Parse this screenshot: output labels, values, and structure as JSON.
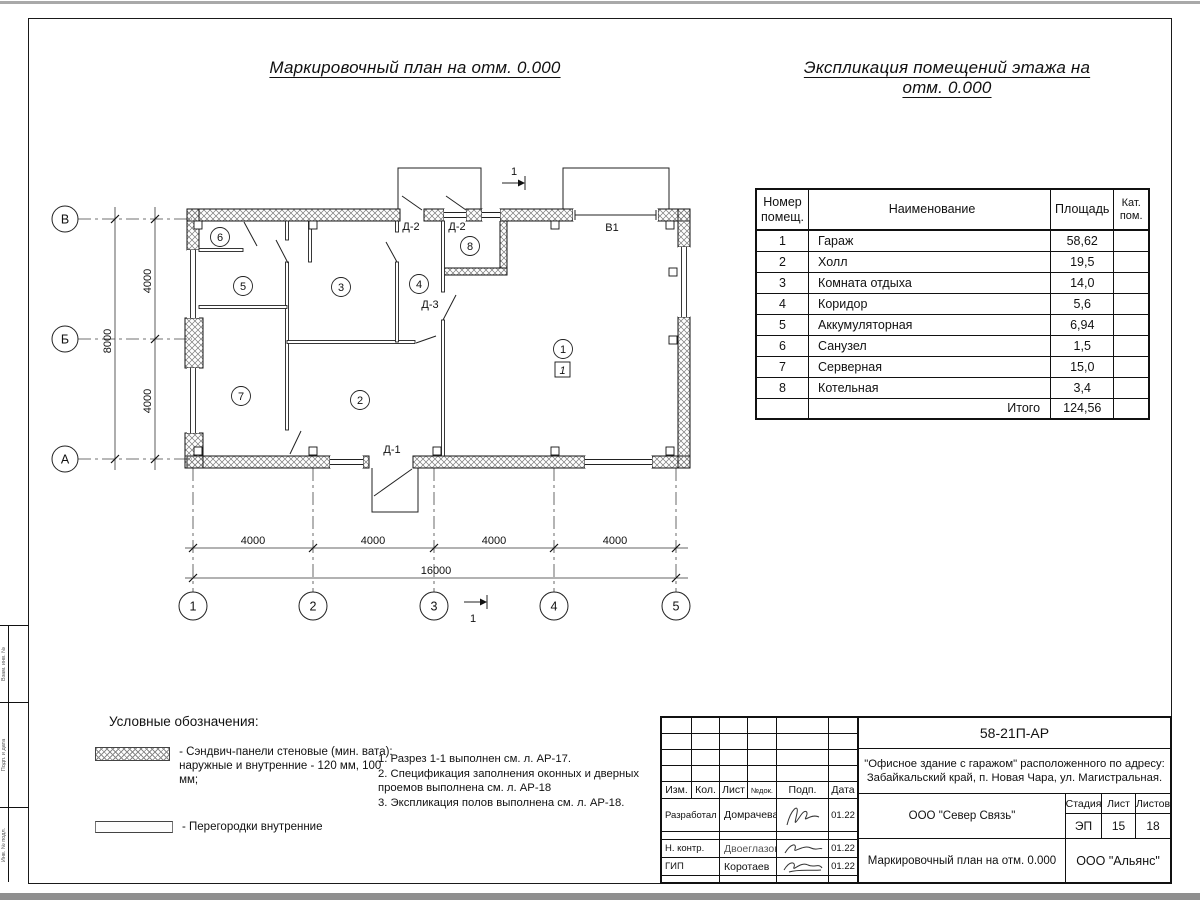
{
  "titles": {
    "plan": "Маркировочный план на отм. 0.000",
    "explication": "Экспликация помещений этажа на отм. 0.000"
  },
  "plan": {
    "axis_rows": [
      "В",
      "Б",
      "А"
    ],
    "axis_cols": [
      "1",
      "2",
      "3",
      "4",
      "5"
    ],
    "dims_v": [
      "4000",
      "4000",
      "8000"
    ],
    "dims_h": [
      "4000",
      "4000",
      "4000",
      "4000"
    ],
    "dim_total": "16000",
    "room_marks": [
      "1",
      "2",
      "3",
      "4",
      "5",
      "6",
      "7",
      "8"
    ],
    "doors": [
      "Д-1",
      "Д-2",
      "Д-2",
      "Д-3"
    ],
    "gate": "В1",
    "section": "1",
    "floor_type": "1"
  },
  "room_table": {
    "headers": {
      "num": "Номер помещ.",
      "name": "Наименование",
      "area": "Площадь",
      "cat": "Кат. пом."
    },
    "rows": [
      {
        "num": "1",
        "name": "Гараж",
        "area": "58,62"
      },
      {
        "num": "2",
        "name": "Холл",
        "area": "19,5"
      },
      {
        "num": "3",
        "name": "Комната отдыха",
        "area": "14,0"
      },
      {
        "num": "4",
        "name": "Коридор",
        "area": "5,6"
      },
      {
        "num": "5",
        "name": "Аккумуляторная",
        "area": "6,94"
      },
      {
        "num": "6",
        "name": "Санузел",
        "area": "1,5"
      },
      {
        "num": "7",
        "name": "Серверная",
        "area": "15,0"
      },
      {
        "num": "8",
        "name": "Котельная",
        "area": "3,4"
      }
    ],
    "total_label": "Итого",
    "total_value": "124,56"
  },
  "legend": {
    "title": "Условные обозначения:",
    "item1_line1": "- Сэндвич-панели стеновые (мин. вата):",
    "item1_line2": "наружные и внутренние - 120 мм, 100 мм;",
    "item2": "- Перегородки внутренние"
  },
  "notes": {
    "lines": [
      "1. Разрез 1-1 выполнен см. л. АР-17.",
      "2. Спецификация заполнения оконных и дверных",
      "проемов выполнена см. л. АР-18",
      "3. Экспликация полов выполнена см. л. АР-18."
    ]
  },
  "side_strip": {
    "labels": [
      "Взам. инв. №",
      "Подп. и дата",
      "Инв. № подл."
    ]
  },
  "titleblock": {
    "doc_number": "58-21П-АР",
    "project_line1": "\"Офисное здание с гаражом\" расположенного по адресу:",
    "project_line2": "Забайкальский край, п. Новая Чара, ул. Магистральная.",
    "org": "ООО \"Север Связь\"",
    "sheet_title": "Маркировочный план на отм. 0.000",
    "company": "ООО \"Альянс\"",
    "stage_label": "Стадия",
    "sheet_label": "Лист",
    "sheets_label": "Листов",
    "stage": "ЭП",
    "sheet": "15",
    "sheets": "18",
    "cols": [
      "Изм.",
      "Кол.",
      "Лист",
      "№док.",
      "Подп.",
      "Дата"
    ],
    "rows": [
      {
        "role": "Разработал",
        "name": "Домрачева",
        "date": "01.22"
      },
      {
        "role": "Н. контр.",
        "name": "Двоеглазов",
        "date": "01.22"
      },
      {
        "role": "ГИП",
        "name": "Коротаев",
        "date": "01.22"
      }
    ]
  }
}
